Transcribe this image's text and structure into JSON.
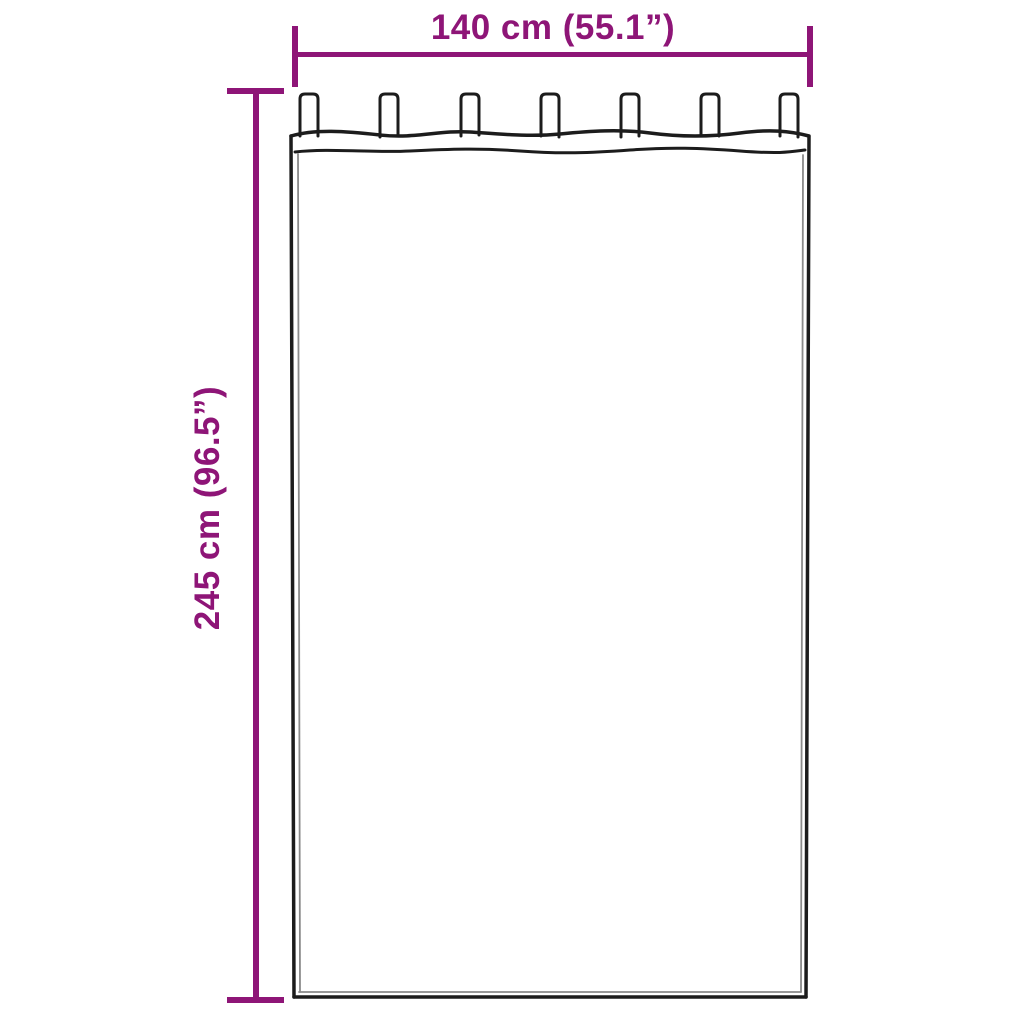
{
  "diagram": {
    "kind": "product-dimension-diagram",
    "background": "#ffffff",
    "accent_color": "#8E1577",
    "outline_color": "#1c1c1c",
    "inner_line_color": "#8a8a8a",
    "width_dimension": {
      "label": "140 cm (55.1”)"
    },
    "height_dimension": {
      "label": "245 cm (96.5”)"
    },
    "curtain": {
      "type": "tab-top-curtain",
      "tab_count": 7
    }
  }
}
